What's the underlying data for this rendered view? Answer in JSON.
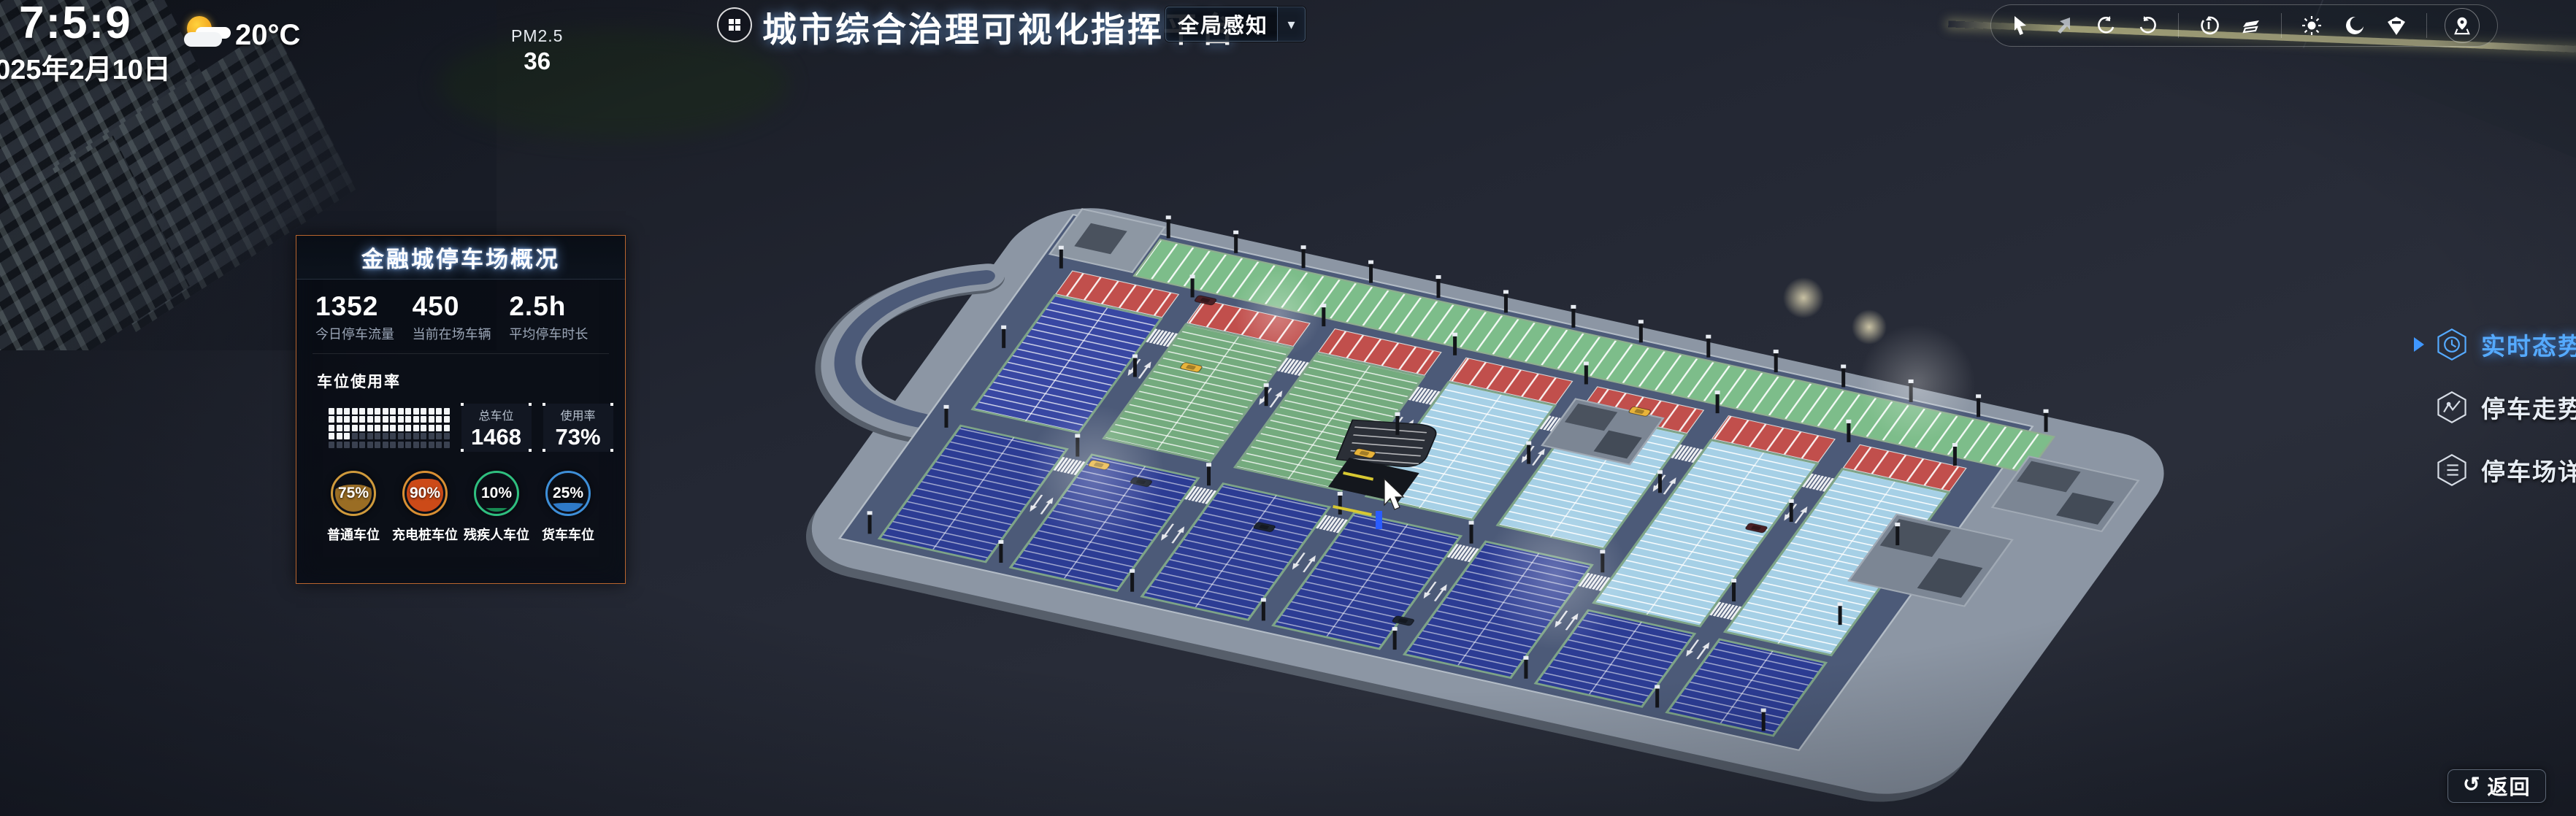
{
  "clock": {
    "time": "7:5:9",
    "date": "2025年2月10日"
  },
  "weather": {
    "temp": "20°C",
    "pm_label": "PM2.5",
    "pm_value": "36"
  },
  "header": {
    "title": "城市综合治理可视化指挥平台",
    "mode_button": "全局感知",
    "caret": "▾"
  },
  "toolbar": {
    "icons": [
      "select-cursor",
      "pan-cursor",
      "rotate-ccw-icon",
      "rotate-cw-icon",
      "reset-view-icon",
      "layers-icon",
      "day-mode-icon",
      "night-mode-icon",
      "marker-pin-icon",
      "locate-icon"
    ]
  },
  "panel": {
    "title": "金融城停车场概况",
    "stats": [
      {
        "value": "1352",
        "label": "今日停车流量"
      },
      {
        "value": "450",
        "label": "当前在场车辆"
      },
      {
        "value": "2.5h",
        "label": "平均停车时长"
      }
    ],
    "usage_section": "车位使用率",
    "waffle": {
      "cols": 16,
      "rows": 5,
      "filled": 51
    },
    "total_box": {
      "label": "总车位",
      "value": "1468"
    },
    "usage_box": {
      "label": "使用率",
      "value": "73%"
    },
    "gauges": [
      {
        "value": "75%",
        "label": "普通车位",
        "ring": "#cf9a3c",
        "fill": "#9a6d24"
      },
      {
        "value": "90%",
        "label": "充电桩车位",
        "ring": "#d98f33",
        "fill": "#cc4a18"
      },
      {
        "value": "10%",
        "label": "残疾人车位",
        "ring": "#2fbf7f",
        "fill": "#178a52"
      },
      {
        "value": "25%",
        "label": "货车车位",
        "ring": "#3e8fd8",
        "fill": "#2e7ac8"
      }
    ]
  },
  "right_menu": {
    "items": [
      {
        "label": "实时态势",
        "icon": "clock-hex-icon",
        "active": true
      },
      {
        "label": "停车走势",
        "icon": "trend-hex-icon",
        "active": false
      },
      {
        "label": "停车场详情",
        "icon": "list-hex-icon",
        "active": false
      }
    ]
  },
  "back_button": {
    "label": "返回",
    "icon": "↺"
  },
  "scene_colors": {
    "deck": "#4c5a78",
    "apron": "#8c96a4",
    "stall_blue": "#3847a3",
    "stall_navy": "#2c3c94",
    "stall_green": "#74ab7e",
    "stall_lightblue": "#a6d0e6",
    "stall_red": "#c14f4c",
    "top_green": "#7dbd8a"
  }
}
